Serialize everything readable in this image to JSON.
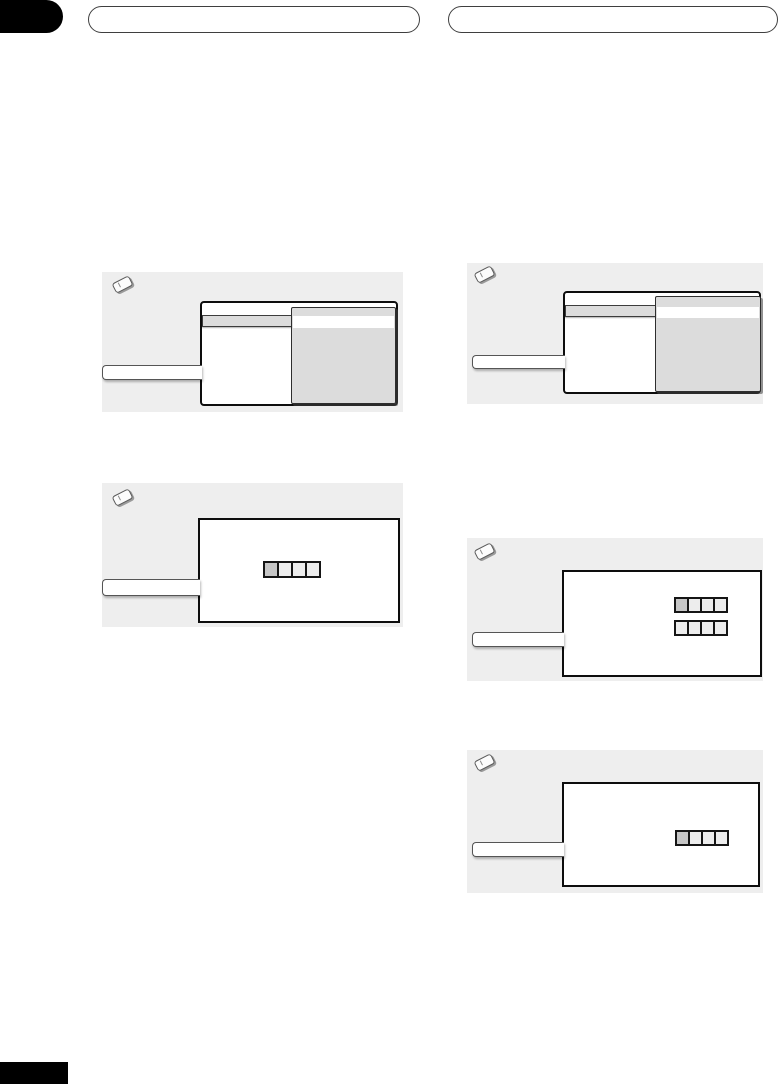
{
  "document": {
    "kind": "printed-manual-page-template",
    "header": {
      "corner_tab_color": "#000000",
      "left_title": "",
      "right_title": ""
    },
    "footer": {
      "page_number_block_color": "#000000",
      "page_number_text": ""
    },
    "colors": {
      "note_panel_bg": "#eeeeee",
      "screen_bg": "#ffffff",
      "screen_border": "#0d0d0d",
      "submenu_bg": "#dcdcdc",
      "highlight_row_bg": "#dcdcdc",
      "selected_square": "#c6c6c6",
      "unselected_square": "#ededed"
    },
    "notes": [
      {
        "id": "left-1",
        "icon": "pencil-note-icon",
        "figure": "setup-menu-screen-with-open-submenu",
        "callout": "label-bar"
      },
      {
        "id": "left-2",
        "icon": "pencil-note-icon",
        "figure": "screen-with-one-option-square-row",
        "callout": "label-bar"
      },
      {
        "id": "right-1",
        "icon": "pencil-note-icon",
        "figure": "setup-menu-screen-with-open-submenu",
        "callout": "label-bar"
      },
      {
        "id": "right-2",
        "icon": "pencil-note-icon",
        "figure": "screen-with-two-option-square-rows",
        "callout": "label-bar"
      },
      {
        "id": "right-3",
        "icon": "pencil-note-icon",
        "figure": "screen-with-one-option-square-row",
        "callout": "label-bar"
      }
    ],
    "figures": {
      "left2_row": [
        "selected",
        "normal",
        "normal",
        "normal"
      ],
      "right2_row1": [
        "selected",
        "normal",
        "normal",
        "normal"
      ],
      "right2_row2": [
        "normal",
        "normal",
        "normal",
        "normal"
      ],
      "right3_row": [
        "selected",
        "normal",
        "normal",
        "normal"
      ]
    }
  }
}
